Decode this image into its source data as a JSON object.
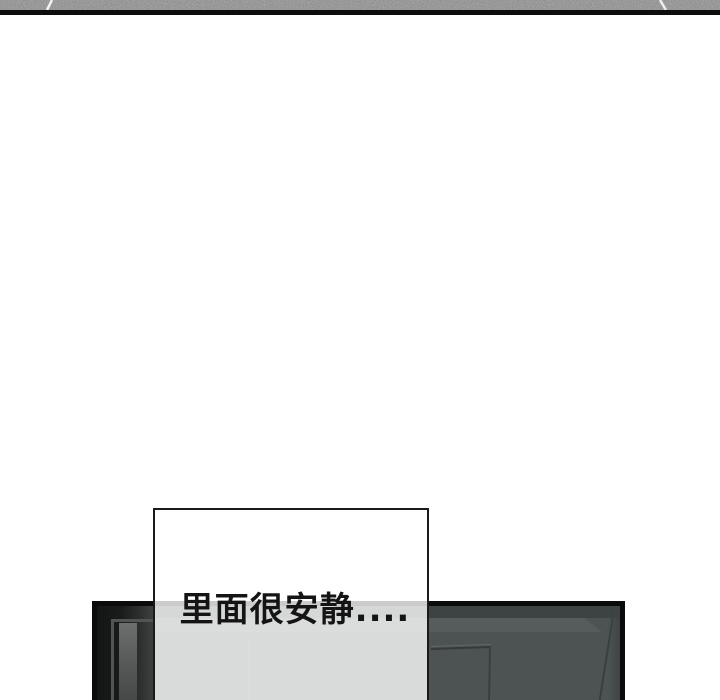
{
  "scene": {
    "kind": "webtoon-comic-strip",
    "dialogue": {
      "text": "里面很安静...."
    }
  },
  "theme": {
    "page_bg": "#ffffff",
    "floor_base": "#8a8a8a",
    "floor_seam": "#f4f4f4",
    "floor_edge": "#0d0d0d",
    "panel_border": "#0b0b0b",
    "panel_wall": "#4d5352",
    "panel_wall_dark": "#3d4342",
    "panel_wall_light": "#565c5b",
    "panel_shadow": "#141615",
    "bubble_border": "#1a1a1a",
    "bubble_fill": "rgba(255,255,255,0.79)",
    "text_color": "#141414"
  }
}
